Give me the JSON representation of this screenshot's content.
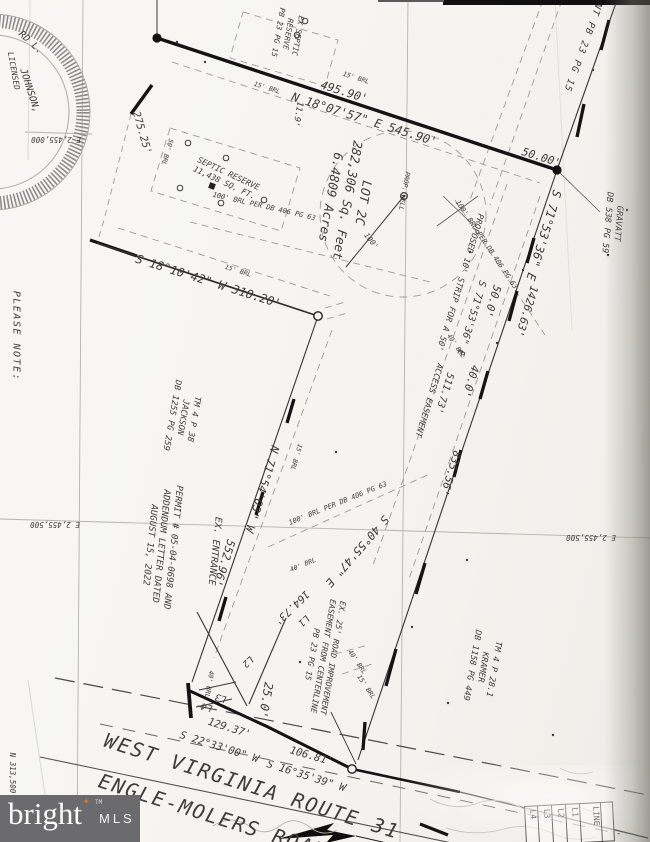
{
  "colors": {
    "paper": "#f6f5f1",
    "ink": "#1c1c1c",
    "faint": "#9b978f",
    "logo_bg": "#6b6a6c",
    "star_orange": "#e8772e"
  },
  "watermark": {
    "brand": "bright",
    "tm": "TM",
    "suffix": "MLS"
  },
  "line_table": {
    "columns": [
      "L4",
      "L3",
      "L2",
      "L1",
      "LINE"
    ]
  },
  "lot": {
    "name": "LOT 2C",
    "area_sqft": "282,306 Sq. Feet",
    "area_acres": "6.4809 Acres"
  },
  "map_labels": [
    {
      "name": "label-please-note",
      "text": "PLEASE NOTE:",
      "x": 16,
      "y": 336,
      "rot": 90,
      "size": 10,
      "spacing": 1.5
    },
    {
      "name": "grid-label-e2455000",
      "text": "E 2,455,000",
      "x": 56,
      "y": 139,
      "rot": 180,
      "size": 7.5
    },
    {
      "name": "grid-label-e2455500-left",
      "text": "E 2,455,500",
      "x": 55,
      "y": 524,
      "rot": 180,
      "size": 7.5
    },
    {
      "name": "grid-label-e2455500-right",
      "text": "E 2,455,500",
      "x": 591,
      "y": 537,
      "rot": 180,
      "size": 7.5
    },
    {
      "name": "grid-label-n313500",
      "text": "N 313,500",
      "x": 12,
      "y": 773,
      "rot": 90,
      "size": 7.5
    },
    {
      "name": "seal-name-arc-1",
      "text": "RD L.",
      "x": 30,
      "y": 43,
      "rot": 42,
      "size": 9.5
    },
    {
      "name": "seal-name-arc-2",
      "text": "JOHNSON,",
      "x": 29,
      "y": 91,
      "rot": 72,
      "size": 9.5
    },
    {
      "name": "seal-licensed",
      "text": "LICENSED",
      "x": 13,
      "y": 71,
      "rot": 80,
      "size": 8
    },
    {
      "name": "bearing-top",
      "text": "N 18°07'57\" E  545.90'",
      "x": 364,
      "y": 120,
      "rot": 17.5,
      "size": 12
    },
    {
      "name": "dist-495-90",
      "text": "495.90'",
      "x": 344,
      "y": 92,
      "rot": 17.5,
      "size": 11.5
    },
    {
      "name": "brl-15-top-right",
      "text": "15' BRL",
      "x": 356,
      "y": 78,
      "rot": 17.5,
      "size": 6.5
    },
    {
      "name": "brl-15-top-left",
      "text": "15' BRL",
      "x": 267,
      "y": 88,
      "rot": 17.5,
      "size": 6.5
    },
    {
      "name": "dim-11-9",
      "text": "11.9'",
      "x": 297,
      "y": 114,
      "rot": 100,
      "size": 8.5
    },
    {
      "name": "dist-50-00",
      "text": "50.00'",
      "x": 541,
      "y": 158,
      "rot": 17.5,
      "size": 11
    },
    {
      "name": "adjoiner-easement-pb23",
      "text": "NT PB 23 PG 15",
      "x": 582,
      "y": 47,
      "rot": 110,
      "size": 9.5,
      "spacing": 1
    },
    {
      "name": "adjoiner-gravatt",
      "lines": [
        "GRAVATT",
        "DB 538 PG 59"
      ],
      "x": 612,
      "y": 223,
      "rot": 95,
      "size": 8.5
    },
    {
      "name": "bearing-s71-main",
      "text": "S 71°53'36\" E",
      "x": 543,
      "y": 235,
      "rot": 107,
      "size": 12
    },
    {
      "name": "dist-1426-63",
      "text": "1426.63'",
      "x": 526,
      "y": 311,
      "rot": 107,
      "size": 11
    },
    {
      "name": "dist-50-0",
      "text": "50.0'",
      "x": 492,
      "y": 301,
      "rot": 107,
      "size": 11
    },
    {
      "name": "dist-40-0",
      "text": "40.0'",
      "x": 470,
      "y": 381,
      "rot": 107,
      "size": 11
    },
    {
      "name": "dist-835-56",
      "text": "835.56'",
      "x": 450,
      "y": 473,
      "rot": 107,
      "size": 11
    },
    {
      "name": "bearing-s71-strip",
      "text": "S 71°53'36\" E",
      "x": 471,
      "y": 318,
      "rot": 107,
      "size": 10
    },
    {
      "name": "dist-511-73",
      "text": "511.73'",
      "x": 444,
      "y": 393,
      "rot": 107,
      "size": 10
    },
    {
      "name": "label-proposed-strip",
      "text": "PROPOSED 10' STRIP FOR A 50'",
      "x": 459,
      "y": 282,
      "rot": 107,
      "size": 8.5
    },
    {
      "name": "label-access-easement",
      "text": "ACCESS EASEMENT",
      "x": 428,
      "y": 400,
      "rot": 107,
      "size": 8.5
    },
    {
      "name": "brl-100-strip",
      "text": "100' BRL PER DB 406 PG 63",
      "x": 486,
      "y": 245,
      "rot": 56,
      "size": 7
    },
    {
      "name": "brl-100-septic",
      "text": "100' BRL PER DB 406 PG 63",
      "x": 264,
      "y": 207,
      "rot": 13,
      "size": 7
    },
    {
      "name": "brl-100-south",
      "text": "100' BRL PER DB 406 PG 63",
      "x": 338,
      "y": 504,
      "rot": -22,
      "size": 7
    },
    {
      "name": "brl-40-strip",
      "text": "40' BRL",
      "x": 456,
      "y": 346,
      "rot": 56,
      "size": 6.5
    },
    {
      "name": "brl-40-south",
      "text": "40' BRL",
      "x": 303,
      "y": 565,
      "rot": -22,
      "size": 6.5
    },
    {
      "name": "brl-40-road",
      "text": "40' BRL",
      "x": 209,
      "y": 684,
      "rot": 100,
      "size": 6.5
    },
    {
      "name": "brl-40-east",
      "text": "40' BRL",
      "x": 357,
      "y": 662,
      "rot": 56,
      "size": 6.5
    },
    {
      "name": "brl-15-mid",
      "text": "15' BRL",
      "x": 238,
      "y": 271,
      "rot": 17.5,
      "size": 6.5
    },
    {
      "name": "brl-15-west",
      "text": "15' BRL",
      "x": 296,
      "y": 457,
      "rot": 107,
      "size": 6.5
    },
    {
      "name": "brl-15-road",
      "text": "15' BRL",
      "x": 366,
      "y": 687,
      "rot": 56,
      "size": 6.5
    },
    {
      "name": "label-septic-reserve-north",
      "lines": [
        "EX SEPTIC",
        "RESERVE",
        "PB 23 PG 15"
      ],
      "x": 288,
      "y": 34,
      "rot": 100,
      "size": 7.5
    },
    {
      "name": "label-septic-reserve",
      "lines": [
        "SEPTIC RESERVE",
        "11,438 SQ. FT."
      ],
      "x": 226,
      "y": 179,
      "rot": 25,
      "size": 8
    },
    {
      "name": "brl-50",
      "text": "50' BRL",
      "x": 167,
      "y": 152,
      "rot": 107,
      "size": 6.5
    },
    {
      "name": "dist-275-25",
      "text": "275.25'",
      "x": 141,
      "y": 133,
      "rot": 74,
      "size": 10.5
    },
    {
      "name": "label-lot",
      "lines": [
        "LOT 2C",
        "282,306 Sq. Feet",
        "6.4809 Acres"
      ],
      "x": 347,
      "y": 200,
      "rot": 100,
      "size": 12.5
    },
    {
      "name": "label-prop-well",
      "text": "PROP. WELL",
      "x": 404,
      "y": 191,
      "rot": 100,
      "size": 6.5
    },
    {
      "name": "dim-100-radius",
      "text": "100'",
      "x": 371,
      "y": 241,
      "rot": 52,
      "size": 7.5
    },
    {
      "name": "bearing-s18",
      "text": "S 18°10'42\" W  310.20'",
      "x": 208,
      "y": 282,
      "rot": 17.5,
      "size": 12
    },
    {
      "name": "label-tm-jackson",
      "lines": [
        "TM 4 P 38",
        "JACKSON",
        "DB 1255 PG 259"
      ],
      "x": 182,
      "y": 417,
      "rot": 100,
      "size": 8.5
    },
    {
      "name": "bearing-n71",
      "text": "N 71°54'03\" W",
      "x": 262,
      "y": 489,
      "rot": 107,
      "size": 11.5
    },
    {
      "name": "dist-552-96",
      "text": "552.96'",
      "x": 224,
      "y": 563,
      "rot": 107,
      "size": 11.5
    },
    {
      "name": "label-permit",
      "lines": [
        "PERMIT # 05-04-0698 AND",
        "ADDENDUM LETTER DATED",
        "AUGUST 15, 2022"
      ],
      "x": 160,
      "y": 546,
      "rot": 96,
      "size": 9
    },
    {
      "name": "label-ex-entrance",
      "text": "EX. ENTRANCE",
      "x": 214,
      "y": 551,
      "rot": 96,
      "size": 9.5
    },
    {
      "name": "bearing-s40",
      "text": "S 40°55'47\" E",
      "x": 357,
      "y": 551,
      "rot": 131,
      "size": 11.5
    },
    {
      "name": "dist-164-73",
      "text": "164.73'",
      "x": 291,
      "y": 607,
      "rot": 136,
      "size": 10.5
    },
    {
      "name": "label-l1",
      "text": "L1",
      "x": 303,
      "y": 620,
      "rot": 136,
      "size": 9.5
    },
    {
      "name": "label-l2",
      "text": "L2",
      "x": 247,
      "y": 661,
      "rot": 136,
      "size": 9.5
    },
    {
      "name": "label-l3",
      "text": "L3",
      "x": 221,
      "y": 697,
      "rot": 196,
      "size": 9.5
    },
    {
      "name": "label-l4",
      "text": "L4",
      "x": 207,
      "y": 706,
      "rot": 196,
      "size": 9.5
    },
    {
      "name": "dim-25-0",
      "text": "25.0'",
      "x": 265,
      "y": 700,
      "rot": 100,
      "size": 12
    },
    {
      "name": "label-road-improvement",
      "lines": [
        "EX. 25' ROAD IMPROVEMENT",
        "EASEMENT FROM CENTERLINE",
        "PB 23 PG 15"
      ],
      "x": 322,
      "y": 656,
      "rot": 100,
      "size": 8
    },
    {
      "name": "label-tm-kramer",
      "lines": [
        "TM 4 P 28.1",
        "KRAMER",
        "DB 1158 PG 449"
      ],
      "x": 482,
      "y": 667,
      "rot": 100,
      "size": 8.5
    },
    {
      "name": "dist-129-37",
      "text": "129.37'",
      "x": 229,
      "y": 729,
      "rot": 17.5,
      "size": 10.5
    },
    {
      "name": "bearing-s22",
      "text": "S 22°33'00\" W",
      "x": 219,
      "y": 748,
      "rot": 17.5,
      "size": 10.5
    },
    {
      "name": "dist-106-81",
      "text": "106.81'",
      "x": 311,
      "y": 757,
      "rot": 16,
      "size": 10.5
    },
    {
      "name": "bearing-s16",
      "text": "S 16°35'39\" W",
      "x": 306,
      "y": 777,
      "rot": 17.5,
      "size": 10.5
    },
    {
      "name": "road-name-line1",
      "text": "WEST VIRGINIA ROUTE 31",
      "x": 252,
      "y": 786,
      "rot": 17.5,
      "size": 20,
      "spacing": 2
    },
    {
      "name": "road-name-line2",
      "text": "ENGLE-MOLERS ROAD",
      "x": 213,
      "y": 816,
      "rot": 17.5,
      "size": 20,
      "spacing": 2
    }
  ]
}
